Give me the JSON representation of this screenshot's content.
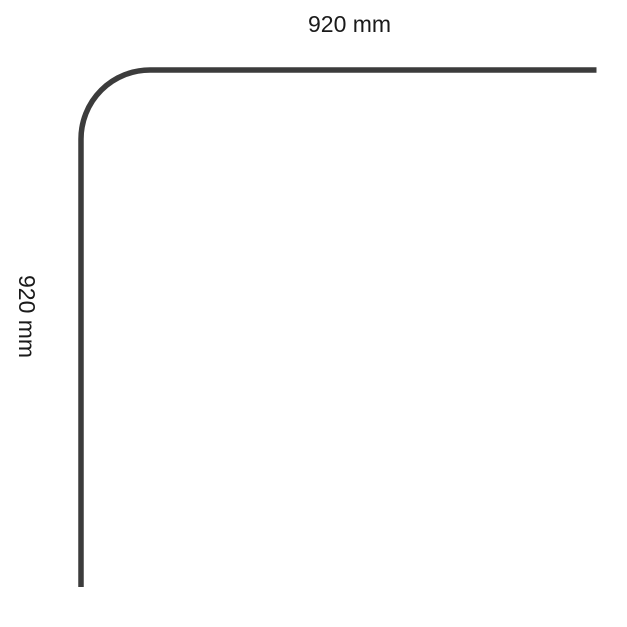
{
  "diagram": {
    "description": "Corner rail dimension drawing",
    "horizontal_dimension_label": "920 mm",
    "vertical_dimension_label": "920 mm",
    "rail_color": "#3c3c3c",
    "background_color": "#ffffff"
  }
}
